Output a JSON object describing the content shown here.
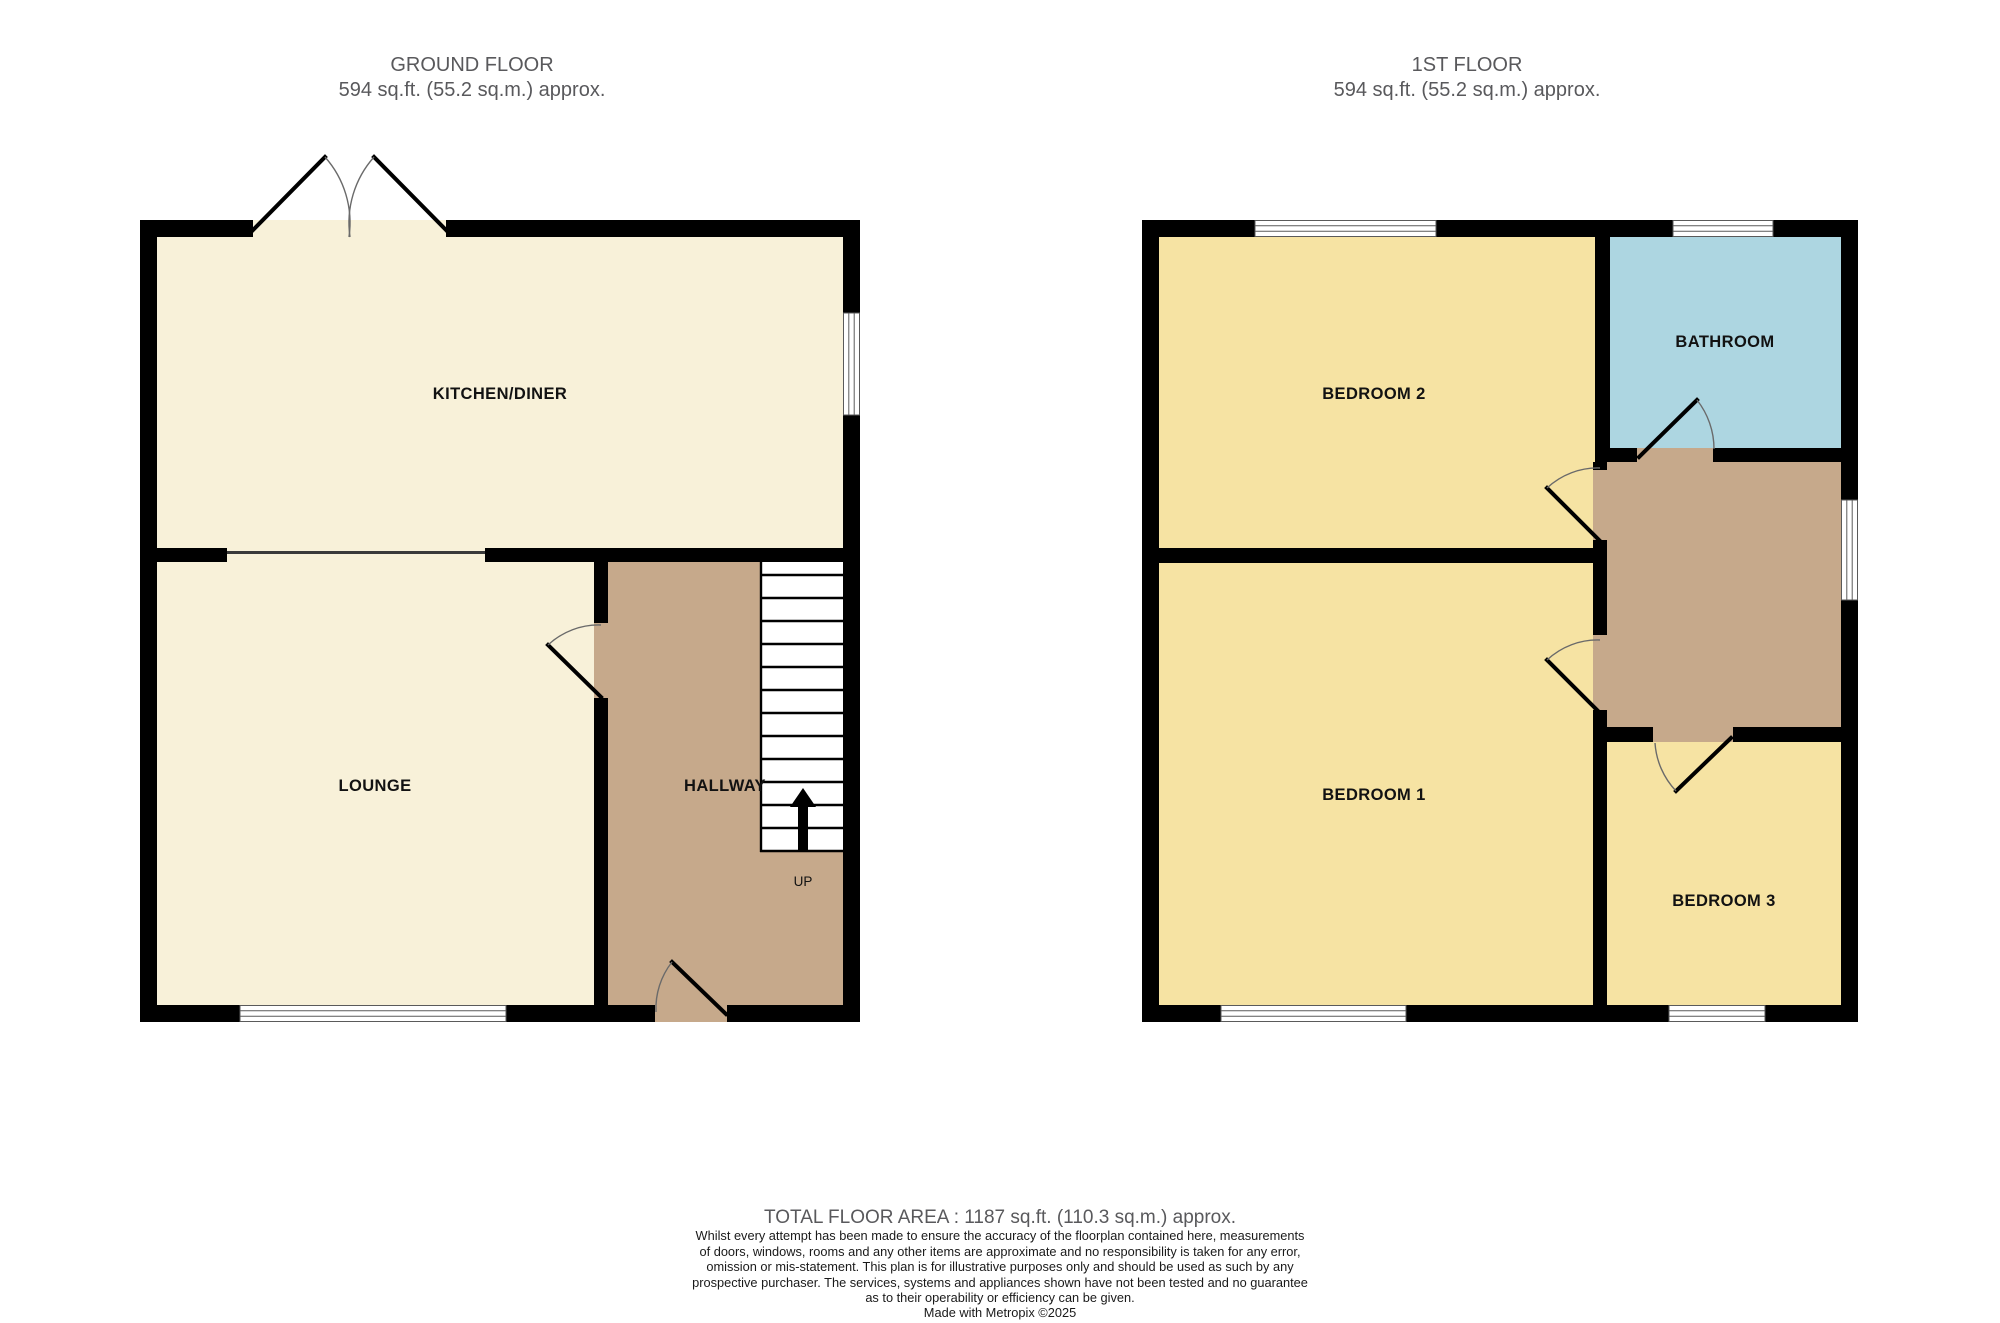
{
  "colors": {
    "wall": "#000000",
    "room_cream": "#F8F1D9",
    "room_yellow": "#F6E3A3",
    "room_blue": "#ADD6E1",
    "hall_brown": "#C6A98B",
    "title_gray": "#59595C"
  },
  "ground_floor": {
    "title": "GROUND FLOOR",
    "area": "594 sq.ft. (55.2 sq.m.) approx.",
    "labels": {
      "kitchen": "KITCHEN/DINER",
      "lounge": "LOUNGE",
      "hallway": "HALLWAY",
      "up": "UP"
    }
  },
  "first_floor": {
    "title": "1ST FLOOR",
    "area": "594 sq.ft. (55.2 sq.m.) approx.",
    "labels": {
      "bedroom2": "BEDROOM 2",
      "bathroom": "BATHROOM",
      "bedroom1": "BEDROOM 1",
      "bedroom3": "BEDROOM 3"
    }
  },
  "footer": {
    "total_area": "TOTAL FLOOR AREA : 1187 sq.ft. (110.3 sq.m.) approx.",
    "disclaimer_lines": [
      "Whilst every attempt has been made to ensure the accuracy of the floorplan contained here, measurements",
      "of doors, windows, rooms and any other items are approximate and no responsibility is taken for any error,",
      "omission or mis-statement. This plan is for illustrative purposes only and should be used as such by any",
      "prospective purchaser. The services, systems and appliances shown have not been tested and no guarantee",
      "as to their operability or efficiency can be given."
    ],
    "credit": "Made with Metropix ©2025"
  }
}
